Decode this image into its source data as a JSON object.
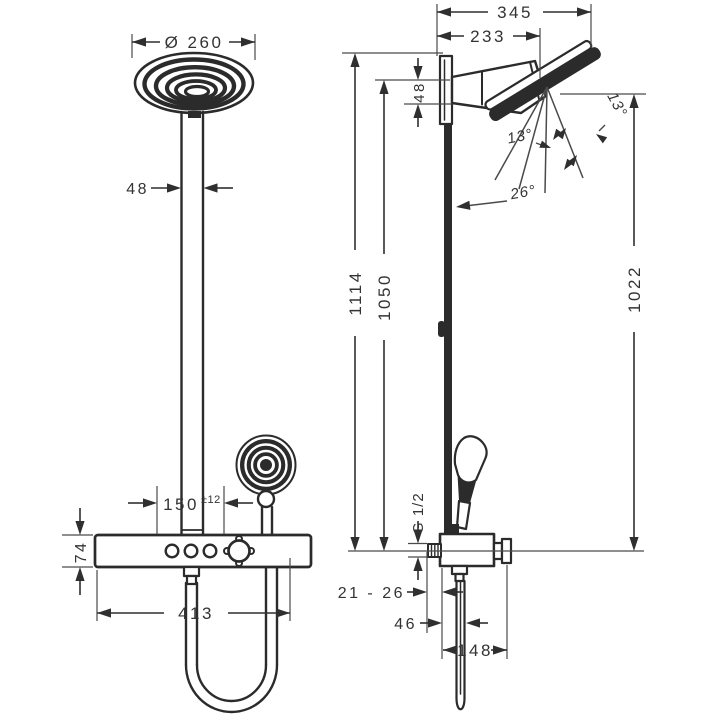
{
  "front_view": {
    "head_diameter": "Ø 260",
    "pipe_width": "48",
    "hand_shower_offset": "150",
    "hand_shower_offset_tolerance": "±12",
    "mixer_height": "74",
    "mixer_width": "413"
  },
  "side_view": {
    "depth_total": "345",
    "depth_head_pivot": "233",
    "arm_thickness": "48",
    "height_total": "1114",
    "height_bar": "1050",
    "height_spray": "1022",
    "head_angle_upper": "13°",
    "head_angle_lower": "13°",
    "bar_angle": "26°",
    "connection_thread": "G 1/2",
    "wall_distance_range": "21 - 26",
    "hose_offset": "46",
    "depth_lower": "148"
  }
}
